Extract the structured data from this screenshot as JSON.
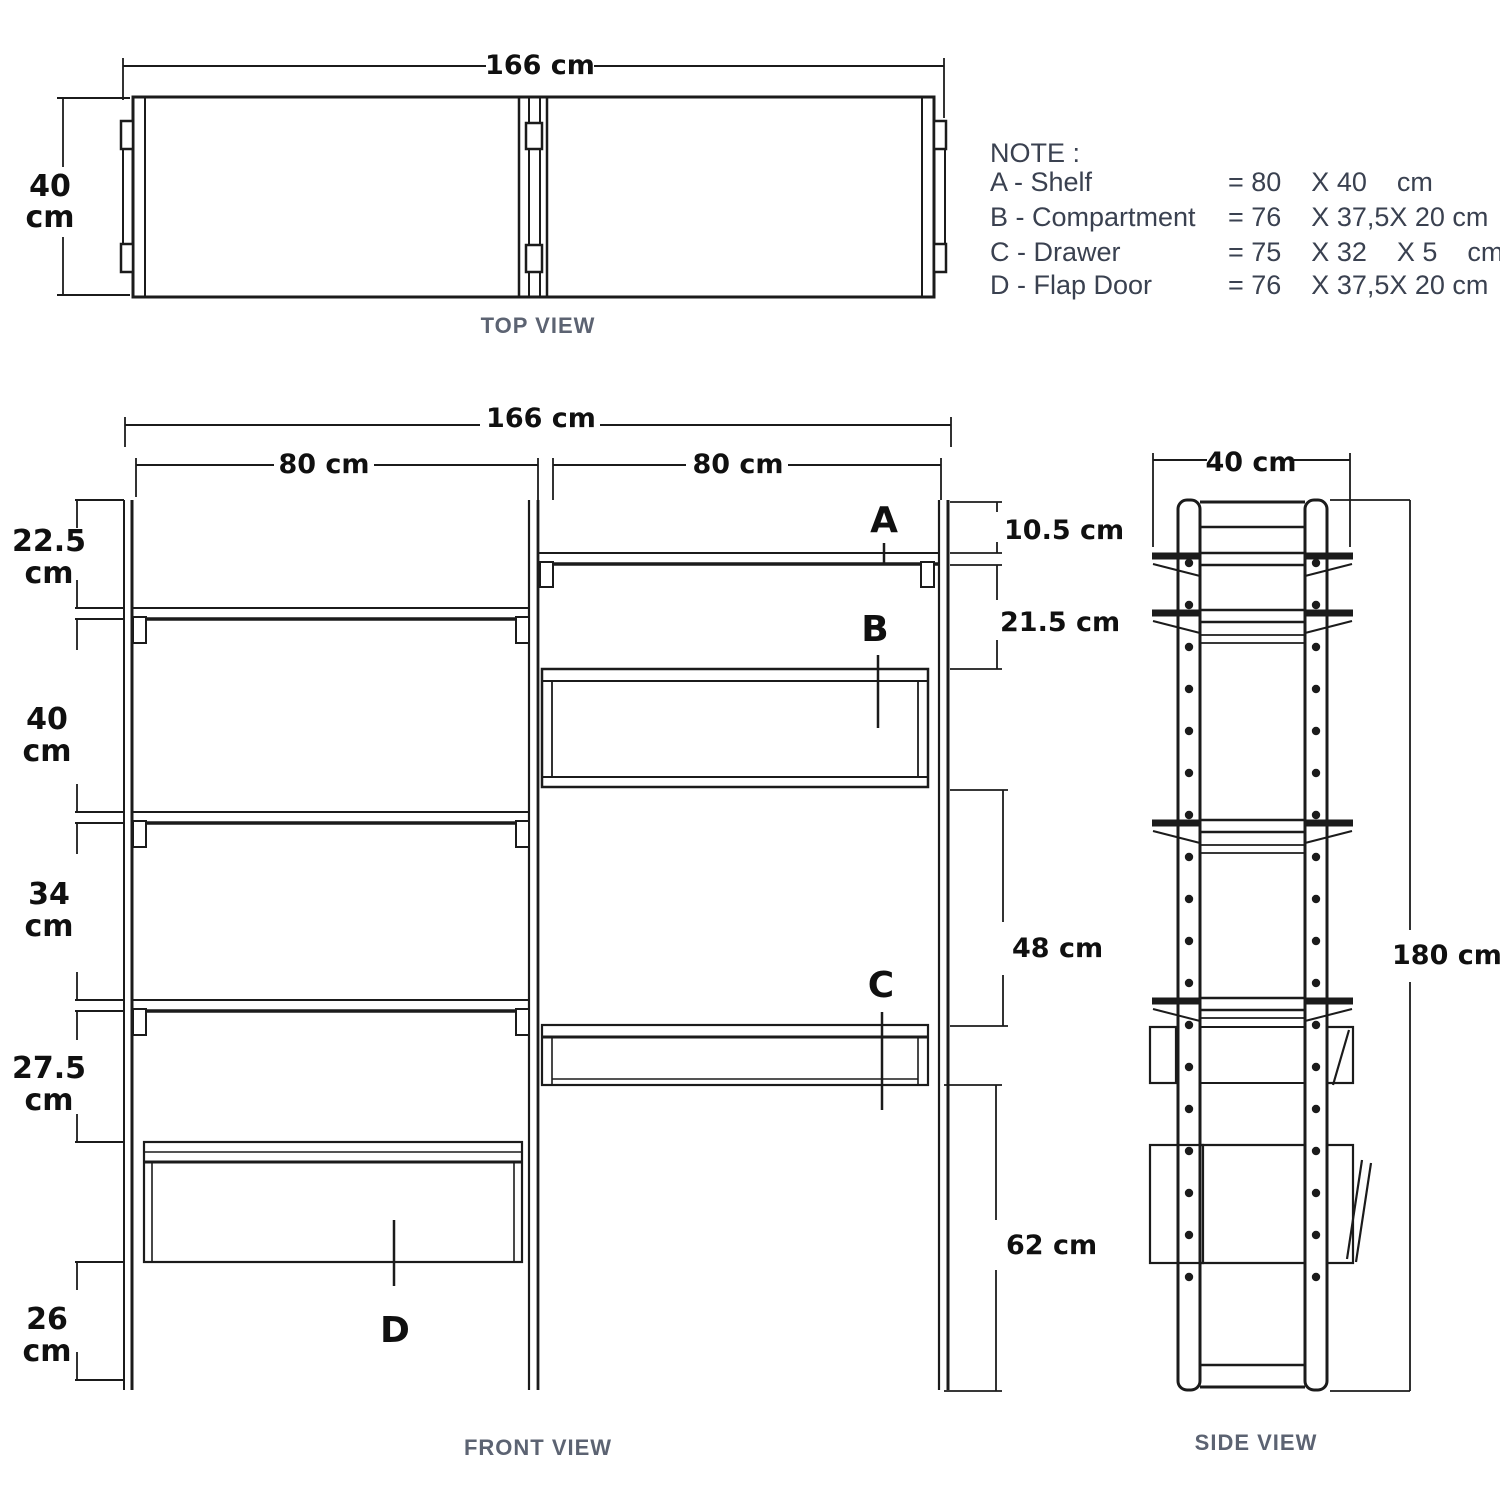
{
  "colors": {
    "line": "#1b1b1b",
    "caption": "#5c6372",
    "note_text": "#3a4150"
  },
  "top_view": {
    "caption": "TOP VIEW",
    "width_dim": "166 cm",
    "depth_dim_value": "40",
    "depth_dim_unit": "cm"
  },
  "note": {
    "title": "NOTE :",
    "items": [
      {
        "label": "A - Shelf",
        "value": "= 80    X 40    cm"
      },
      {
        "label": "B - Compartment",
        "value": "= 76    X 37,5X 20 cm"
      },
      {
        "label": "C - Drawer",
        "value": "= 75    X 32    X 5    cm"
      },
      {
        "label": "D - Flap Door",
        "value": "= 76    X 37,5X 20 cm"
      }
    ]
  },
  "front_view": {
    "caption": "FRONT VIEW",
    "total_width_dim": "166 cm",
    "left_width_dim": "80 cm",
    "right_width_dim": "80 cm",
    "left_dims": [
      {
        "value": "22.5",
        "unit": "cm"
      },
      {
        "value": "40",
        "unit": "cm"
      },
      {
        "value": "34",
        "unit": "cm"
      },
      {
        "value": "27.5",
        "unit": "cm"
      },
      {
        "value": "26",
        "unit": "cm"
      }
    ],
    "right_dims": [
      "10.5 cm",
      "21.5 cm",
      "48 cm",
      "62 cm"
    ],
    "part_labels": {
      "a": "A",
      "b": "B",
      "c": "C",
      "d": "D"
    }
  },
  "side_view": {
    "caption": "SIDE VIEW",
    "width_dim": "40 cm",
    "height_dim": "180 cm"
  }
}
